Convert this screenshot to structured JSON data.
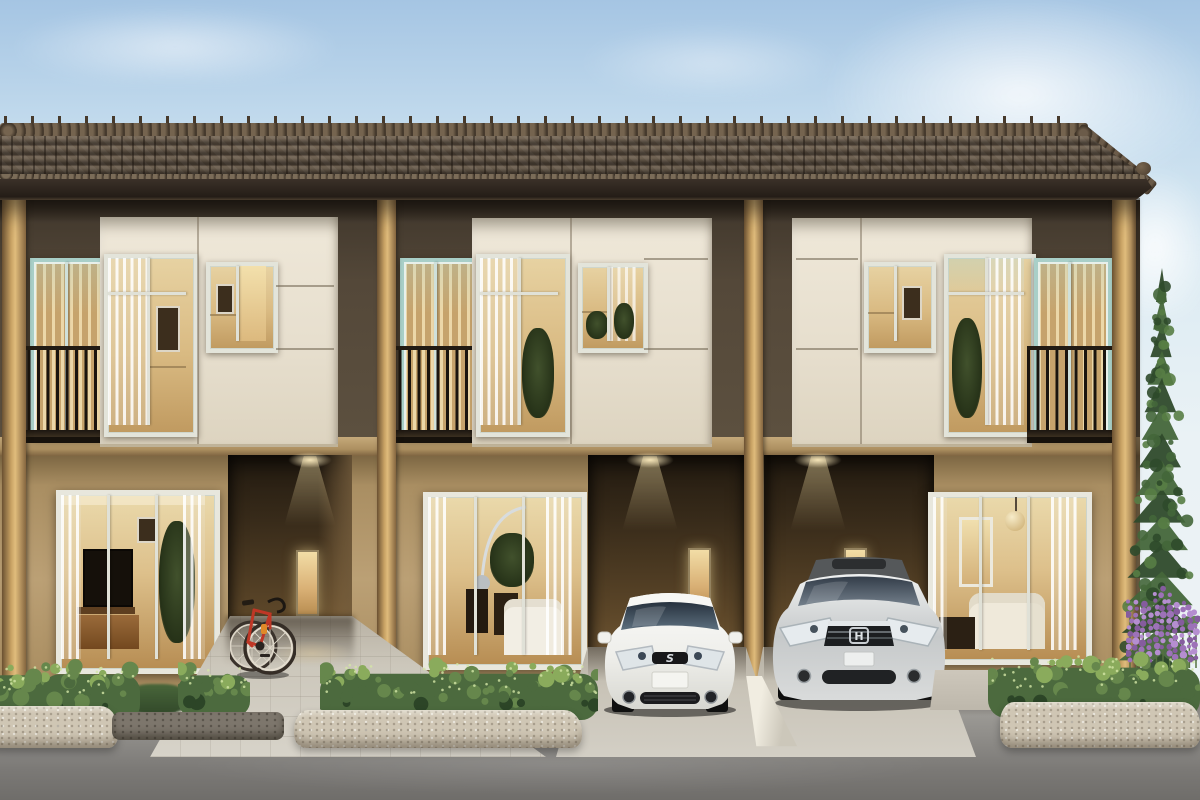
{
  "scene": {
    "description": "Photorealistic rendering of a three-unit two-storey modern townhouse row at dusk with warm interior lights, two parked cars, a red road bicycle, trimmed hedges with stone curbs, lavender flowers and a tall conifer at the right",
    "sky": "clear pale blue with soft clouds",
    "foreground": "grey asphalt street with paved walkway and two concrete driveways"
  },
  "palette": {
    "sky_top": "#a5c5e3",
    "road_dark": "#6f6d6a",
    "roof_dark": "#5e5143",
    "roof_light": "#75644f",
    "fascia": "#3b3129",
    "upper_wall": "#544839",
    "lower_wall": "#bba075",
    "pillar_light": "#e0bc7c",
    "cream": "#efe8d9",
    "teal_frame": "#a9cfc8",
    "railing": "#1a140e",
    "glass_warm": "#ddc08b",
    "glow": "#f5dfae",
    "stone": "#cfc6b4",
    "walk": "#ccc7bb",
    "hedge_base": "#4c6a3e",
    "hedge_mid": "#66874c",
    "hedge_light": "#8aab5c",
    "hedge_dark": "#2c4527",
    "hedge_speckle": "#d3e6a6",
    "pine_dark": "#2f4a2b",
    "pine_mid": "#44663a",
    "pine_light": "#587d45",
    "stem": "#55703f",
    "lav_a": "#9d72b8",
    "lav_b": "#b58ed0",
    "lav_c": "#855c9e",
    "car_white": "#f4f3f0",
    "car_silver": "#c9cccd",
    "bike_red": "#bf3726"
  },
  "building": {
    "storeys": 2,
    "units": [
      {
        "name": "left-unit",
        "upper": "balcony left with teal sliding door, cream panel with two lit windows",
        "ground": "living-room sliding window and entry alcove with downlight, slot window and red bicycle"
      },
      {
        "name": "middle-unit",
        "upper": "balcony left with teal sliding door, cream panel with two lit windows",
        "ground": "living-room sliding window and carport with white hatchback"
      },
      {
        "name": "right-unit",
        "upper": "cream panel with two lit windows, balcony right with teal sliding door",
        "ground": "carport with silver sedan and living-room sliding window"
      }
    ],
    "roof": "dark brown concrete tile with ridge caps, hipped right end",
    "downlight_count": 3
  },
  "vehicles": [
    {
      "name": "white-hatchback",
      "label": "white Suzuki hatchback parked in middle carport",
      "logo_icon": "suzuki-s-logo"
    },
    {
      "name": "silver-sedan",
      "label": "silver Honda sedan parked in right carport",
      "logo_icon": "honda-h-logo"
    },
    {
      "name": "red-road-bike",
      "label": "red road bicycle leaning in left entry alcove"
    }
  ],
  "vegetation": {
    "hedge_rows": 3,
    "conifer": "tall pine at right edge",
    "flowers": "purple lavender spikes beside right hedge",
    "grass_patches": 2
  }
}
